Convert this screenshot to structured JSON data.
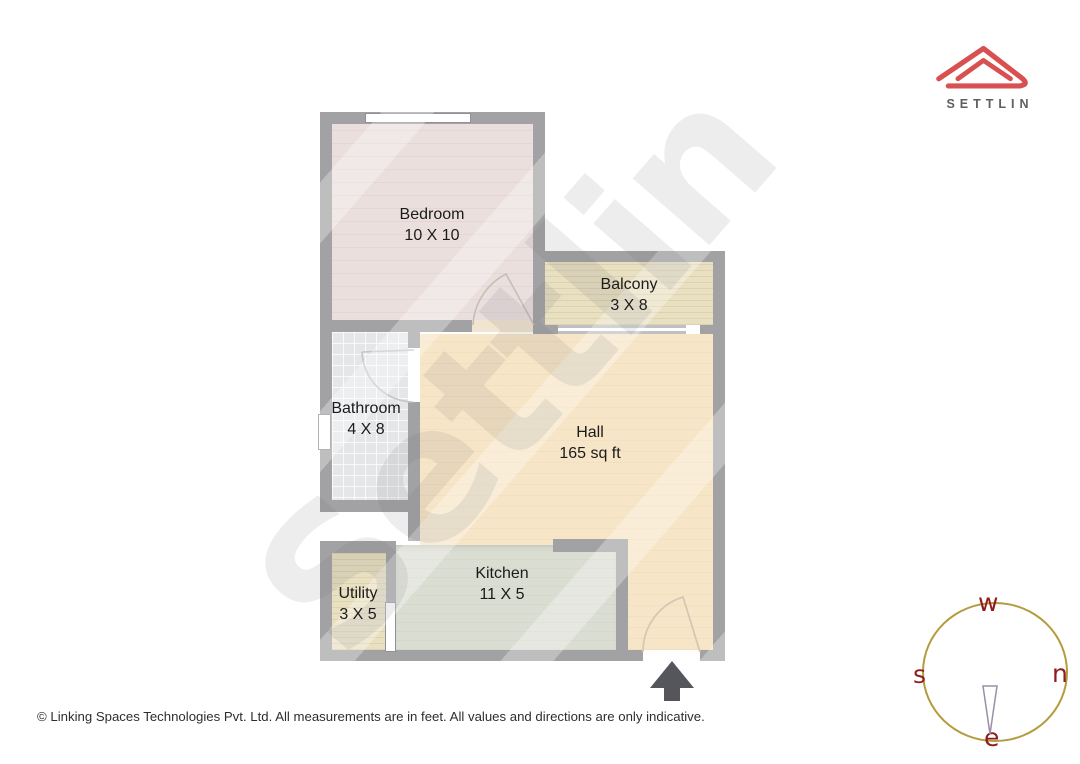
{
  "brand": {
    "name": "SETTLIN",
    "logo_color": "#d95050",
    "text_color": "#5c5e60"
  },
  "watermark": {
    "text": "Settlin"
  },
  "floorplan": {
    "rooms": [
      {
        "key": "bedroom",
        "name": "Bedroom",
        "dimensions": "10 X 10",
        "floor_color": "#ebdfde"
      },
      {
        "key": "balcony",
        "name": "Balcony",
        "dimensions": "3 X 8",
        "floor_color": "#e9e0c1"
      },
      {
        "key": "bathroom",
        "name": "Bathroom",
        "dimensions": "4 X 8",
        "floor_color": "#e4e6e8"
      },
      {
        "key": "hall",
        "name": "Hall",
        "dimensions": "165 sq ft",
        "floor_color": "#f7e5c7"
      },
      {
        "key": "kitchen",
        "name": "Kitchen",
        "dimensions": "11 X 5",
        "floor_color": "#daddd2"
      },
      {
        "key": "utility",
        "name": "Utility",
        "dimensions": "3 X 5",
        "floor_color": "#e9e0c1"
      }
    ],
    "wall_color": "#a2a2a4",
    "entrance_arrow_color": "#55565c",
    "door_arc_color": "#c3c0b4"
  },
  "compass": {
    "labels": {
      "top": "w",
      "left": "s",
      "right": "n",
      "bottom": "e"
    },
    "ring_color": "#b49b3d",
    "letter_color": "#8f1d1d"
  },
  "footer": {
    "text": "© Linking Spaces Technologies Pvt. Ltd. All measurements are in feet. All values and directions are only indicative."
  }
}
